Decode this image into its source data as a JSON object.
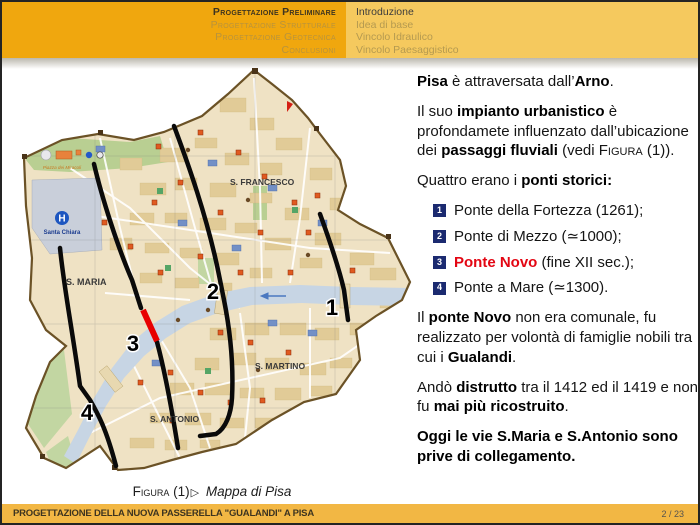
{
  "header": {
    "left_nav": [
      {
        "label": "Progettazione Preliminare",
        "active": true
      },
      {
        "label": "Progettazione Strutturale",
        "active": false
      },
      {
        "label": "Progettazione Geotecnica",
        "active": false
      },
      {
        "label": "Conclusioni",
        "active": false
      }
    ],
    "right_nav": [
      {
        "label": "Introduzione",
        "active": true
      },
      {
        "label": "Idea di base",
        "active": false
      },
      {
        "label": "Vincolo Idraulico",
        "active": false
      },
      {
        "label": "Vincolo Paesaggistico",
        "active": false
      }
    ]
  },
  "map": {
    "districts": [
      "S. FRANCESCO",
      "S. MARIA",
      "S. MARTINO",
      "S. ANTONIO"
    ],
    "hospital": {
      "letter": "H",
      "name": "Santa Chiara"
    },
    "miracoli_label": "Piazza dei Miracoli",
    "route_numbers": {
      "n1": "1",
      "n2": "2",
      "n3": "3",
      "n4": "4"
    },
    "caption": {
      "label": "Figura",
      "number": "(1)",
      "separator": "▷",
      "title": "Mappa di Pisa"
    }
  },
  "content": {
    "p1": [
      {
        "t": "Pisa",
        "s": "b"
      },
      {
        "t": " è attraversata dall’"
      },
      {
        "t": "Arno",
        "s": "b"
      },
      {
        "t": "."
      }
    ],
    "p2": [
      {
        "t": "Il suo "
      },
      {
        "t": "impianto urbanistico",
        "s": "b"
      },
      {
        "t": " è profondamete influenzato dall’ubicazione dei "
      },
      {
        "t": "passaggi fluviali",
        "s": "b"
      },
      {
        "t": " (vedi "
      },
      {
        "t": "Figura",
        "s": "sc"
      },
      {
        "t": " (1))."
      }
    ],
    "p3": [
      {
        "t": "Quattro erano i "
      },
      {
        "t": "ponti storici:",
        "s": "b"
      }
    ],
    "list": [
      {
        "num": "1",
        "segments": [
          {
            "t": "Ponte della Fortezza (1261);"
          }
        ]
      },
      {
        "num": "2",
        "segments": [
          {
            "t": "Ponte di Mezzo (≃1000);"
          }
        ]
      },
      {
        "num": "3",
        "segments": [
          {
            "t": "Ponte Novo",
            "s": "b red"
          },
          {
            "t": " (fine XII sec.);"
          }
        ]
      },
      {
        "num": "4",
        "segments": [
          {
            "t": "Ponte a Mare (≃1300)."
          }
        ]
      }
    ],
    "p4": [
      {
        "t": "Il "
      },
      {
        "t": "ponte Novo",
        "s": "b"
      },
      {
        "t": " non era comunale, fu realizzato per volontà di famiglie nobili tra cui i "
      },
      {
        "t": "Gualandi",
        "s": "b"
      },
      {
        "t": "."
      }
    ],
    "p5": [
      {
        "t": "Andò "
      },
      {
        "t": "distrutto",
        "s": "b"
      },
      {
        "t": " tra il 1412 ed il 1419 e non fu "
      },
      {
        "t": "mai più ricostruito",
        "s": "b"
      },
      {
        "t": "."
      }
    ],
    "p6": [
      {
        "t": "Oggi le vie S.Maria e S.Antonio sono prive di collegamento.",
        "s": "b"
      }
    ]
  },
  "footer": {
    "title": "PROGETTAZIONE DELLA NUOVA PASSERELLA \"GUALANDI\" A PISA",
    "page": "2 / 23"
  },
  "colors": {
    "header_gold_dark": "#f0a70e",
    "header_gold_light": "#f5c95e",
    "footer_gold": "#f2b744",
    "badge_navy": "#1b2a70",
    "highlight_red": "#e30613",
    "river_blue": "#c7d5e4",
    "map_beige": "#efe2c4"
  }
}
